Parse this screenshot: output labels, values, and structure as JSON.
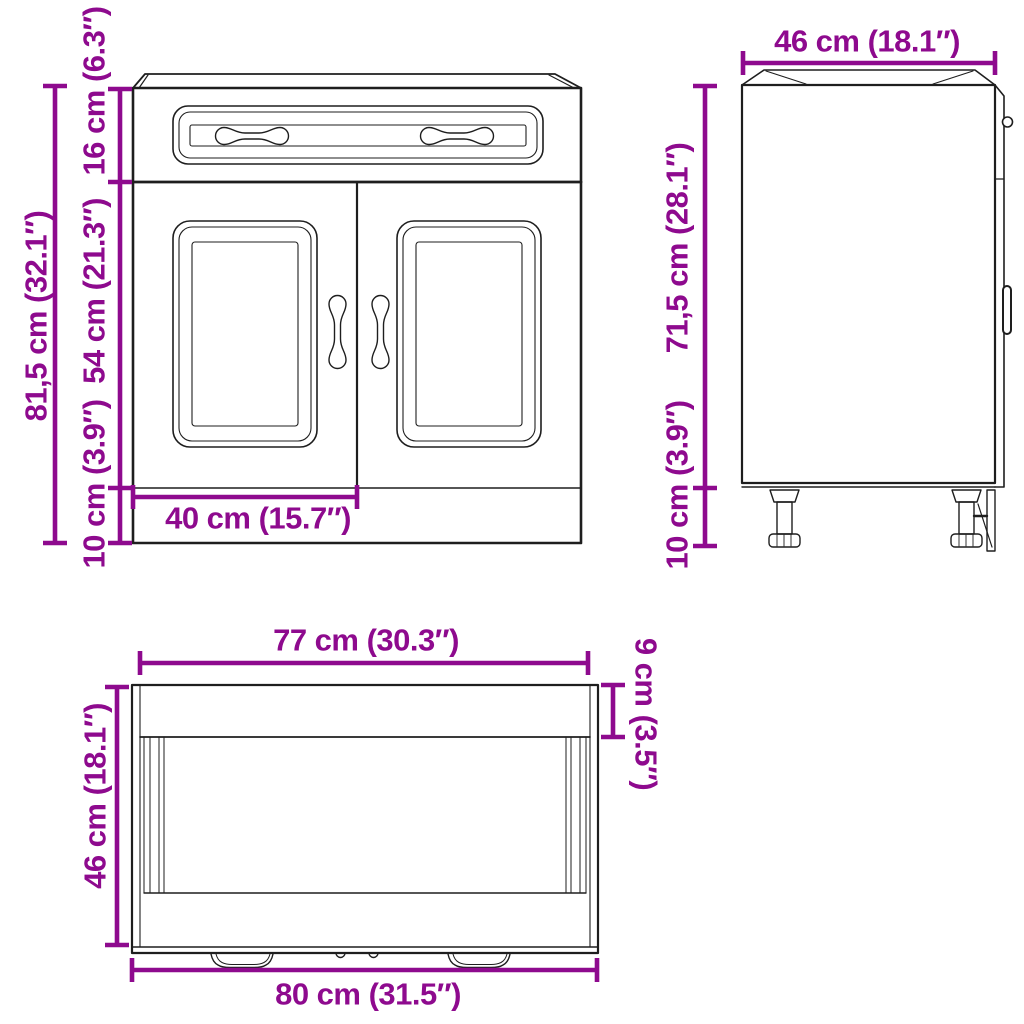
{
  "drawing": {
    "type": "furniture-dimension-diagram",
    "subject": "kitchen base cabinet with one drawer and two doors, adjustable legs",
    "colors": {
      "dimension": "#8E0A8E",
      "line": "#1e1e1e",
      "background": "#ffffff"
    },
    "front_view": {
      "total_height": "81,5 cm (32.1″)",
      "drawer_front_height": "16 cm (6.3″)",
      "door_height": "54 cm (21.3″)",
      "plinth_height": "10 cm (3.9″)",
      "door_width": "40 cm (15.7″)"
    },
    "side_view": {
      "depth": "46 cm (18.1″)",
      "body_height": "71,5 cm (28.1″)",
      "leg_height": "10 cm (3.9″)"
    },
    "bottom_view": {
      "inner_width": "77 cm (30.3″)",
      "counter_depth": "9 cm (3.5″)",
      "depth": "46 cm (18.1″)",
      "total_width": "80 cm (31.5″)"
    }
  }
}
